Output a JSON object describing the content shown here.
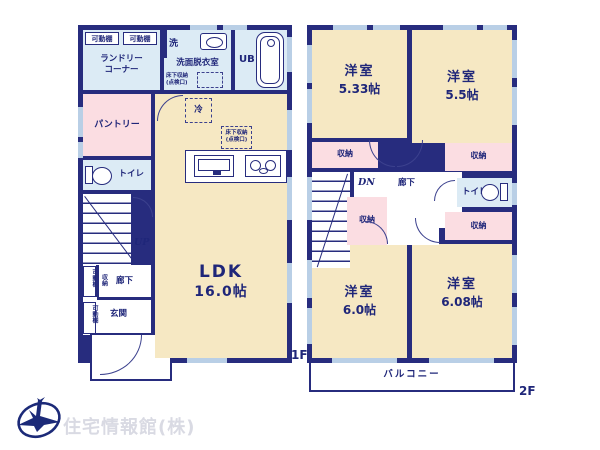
{
  "colors": {
    "wall": "#272c7e",
    "room_cream": "#f6e8c3",
    "room_pink": "#fbdde2",
    "room_blue": "#dcebf5",
    "window": "#b9cfe6",
    "text": "#1f2679",
    "watermark": "#d9dae3"
  },
  "floor1": {
    "floor_label": "1F",
    "laundry": {
      "label": "ランドリー\nコーナー",
      "shelves": [
        "可動棚",
        "可動棚"
      ]
    },
    "washroom": {
      "washer": "洗",
      "label": "洗面脱衣室",
      "floor_storage": "床下収納\n(点検口)"
    },
    "bath": {
      "label": "UB"
    },
    "pantry": {
      "label": "パントリー"
    },
    "toilet": {
      "label": "トイレ"
    },
    "stairs": {
      "label": "UP"
    },
    "hall": {
      "label": "廊下",
      "storage": "収納",
      "shelves": [
        "可動棚",
        "可動棚"
      ]
    },
    "entrance": {
      "label": "玄関"
    },
    "ldk": {
      "name": "LDK",
      "size": "16.0帖",
      "fridge": "冷",
      "floor_storage": "床下収納\n(点検口)"
    }
  },
  "floor2": {
    "floor_label": "2F",
    "rooms": {
      "nw": {
        "name": "洋室",
        "size": "5.33帖"
      },
      "ne": {
        "name": "洋室",
        "size": "5.5帖"
      },
      "sw": {
        "name": "洋室",
        "size": "6.0帖"
      },
      "se": {
        "name": "洋室",
        "size": "6.08帖"
      }
    },
    "closets": [
      "収納",
      "収納",
      "収納",
      "収納"
    ],
    "stairs": {
      "label": "DN"
    },
    "hall": {
      "label": "廊下"
    },
    "toilet": {
      "label": "トイレ"
    },
    "balcony": {
      "label": "バルコニー"
    }
  },
  "footer": {
    "company": "住宅情報館(株)"
  }
}
